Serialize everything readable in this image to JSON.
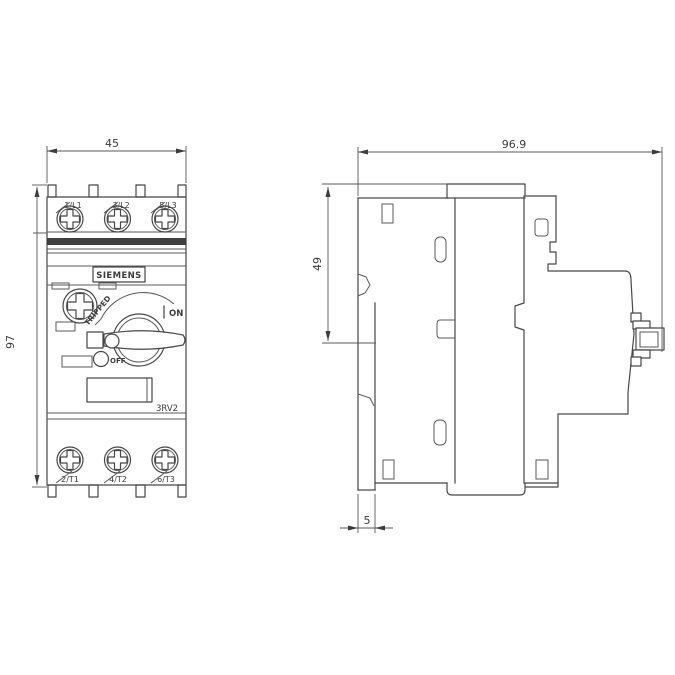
{
  "drawing": {
    "brand": "SIEMENS",
    "model": "3RV2",
    "labels": {
      "tripped": "TRIPPED",
      "on": "ON",
      "off": "OFF"
    },
    "dimensions": {
      "front_width_mm": "45",
      "front_height_mm": "97",
      "side_depth_mm": "96.9",
      "side_upper_height_mm": "49",
      "rail_offset_mm": "5"
    },
    "terminals": {
      "top": [
        "1/L1",
        "3/L2",
        "5/L3"
      ],
      "bottom": [
        "2/T1",
        "4/T2",
        "6/T3"
      ]
    },
    "colors": {
      "line": "#474747",
      "background": "#ffffff"
    }
  }
}
